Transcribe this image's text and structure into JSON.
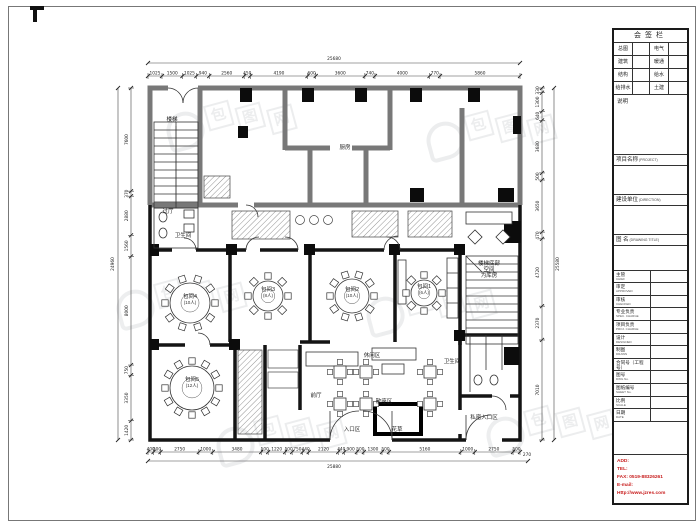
{
  "watermark": {
    "text": "包图网",
    "chars": [
      "包",
      "图",
      "网"
    ]
  },
  "title_block": {
    "sign": {
      "title": "会签栏",
      "rows": [
        [
          "总图",
          "电气"
        ],
        [
          "建筑",
          "暖通"
        ],
        [
          "结构",
          "给水"
        ],
        [
          "给排水",
          "土建"
        ]
      ],
      "note_label": "说明"
    },
    "sections": [
      {
        "label": "项目名称",
        "sub": "(PROJECT)"
      },
      {
        "label": "建设单位",
        "sub": "(DIRECTION)"
      },
      {
        "label": "图  名",
        "sub": "(DRAWING TITLE)"
      }
    ],
    "rows": [
      {
        "label": "主管",
        "sub": "CHIEF"
      },
      {
        "label": "审定",
        "sub": "APPROVED"
      },
      {
        "label": "审核",
        "sub": "CHECKED"
      },
      {
        "label": "专业负责",
        "sub": "SPEC. CHARGE"
      },
      {
        "label": "项目负责",
        "sub": "PROJ. CHARGE"
      },
      {
        "label": "设计",
        "sub": "DESIGNED"
      },
      {
        "label": "制图",
        "sub": "DRAWN"
      },
      {
        "label": "合同号（工程号）",
        "sub": "CONTRACT No."
      },
      {
        "label": "图号",
        "sub": "DWG No."
      },
      {
        "label": "图纸编号",
        "sub": "SHEET No."
      },
      {
        "label": "比例",
        "sub": "SCALE"
      },
      {
        "label": "日期",
        "sub": "DATE"
      }
    ],
    "contact": {
      "color": "#c81e1e",
      "lines": [
        "ADD:",
        "TEL:",
        "FAX: 0519-88326261",
        "E-mail:",
        "Http://www.jzres.com"
      ]
    }
  },
  "plan": {
    "labels": {
      "kitchen": {
        "text": "厨房"
      },
      "stair": {
        "text": "楼梯"
      },
      "vestibule": {
        "text": "过厅"
      },
      "toiletL": {
        "text": "卫生间"
      },
      "room4": {
        "text": "包间4",
        "sub": "(10人)"
      },
      "room3": {
        "text": "包间3",
        "sub": "(8人)"
      },
      "room2": {
        "text": "包间2",
        "sub": "(10人)"
      },
      "room1": {
        "text": "包间1",
        "sub": "(6人)"
      },
      "stairNote": {
        "text": "楼梯底部\n空间\n为库房"
      },
      "room5": {
        "text": "包间5",
        "sub": "(12人)"
      },
      "frontHall": {
        "text": "前厅"
      },
      "entrance": {
        "text": "入口区"
      },
      "flowers": {
        "text": "花草"
      },
      "openSeating": {
        "text": "散座区"
      },
      "loungeArea": {
        "text": "休闲区"
      },
      "toiletR": {
        "text": "卫生间"
      },
      "privateEntrance": {
        "text": "私密入口区"
      }
    },
    "dimensions": {
      "top": {
        "overall": "25680",
        "segments": [
          "1025",
          "1500",
          "1025",
          "940",
          "2560",
          "450",
          "4190",
          "600",
          "3600",
          "740",
          "4000",
          "770",
          "5860"
        ]
      },
      "bottom": {
        "overall": "25880",
        "extra": "270",
        "segments": [
          "400",
          "500",
          "2750",
          "1000",
          "3480",
          "500",
          "1220",
          "500",
          "750",
          "440",
          "2120",
          "440",
          "900",
          "500",
          "1300",
          "500",
          "5160",
          "1000",
          "2750",
          "500"
        ]
      },
      "left": {
        "overall": "24960",
        "segments": [
          "7600",
          "370",
          "2880",
          "1560",
          "8000",
          "750",
          "3350",
          "1420"
        ]
      },
      "right": {
        "overall": "25580",
        "segments": [
          "330",
          "1300",
          "640",
          "3680",
          "500",
          "3650",
          "470",
          "4720",
          "2370",
          "7010"
        ]
      }
    }
  }
}
